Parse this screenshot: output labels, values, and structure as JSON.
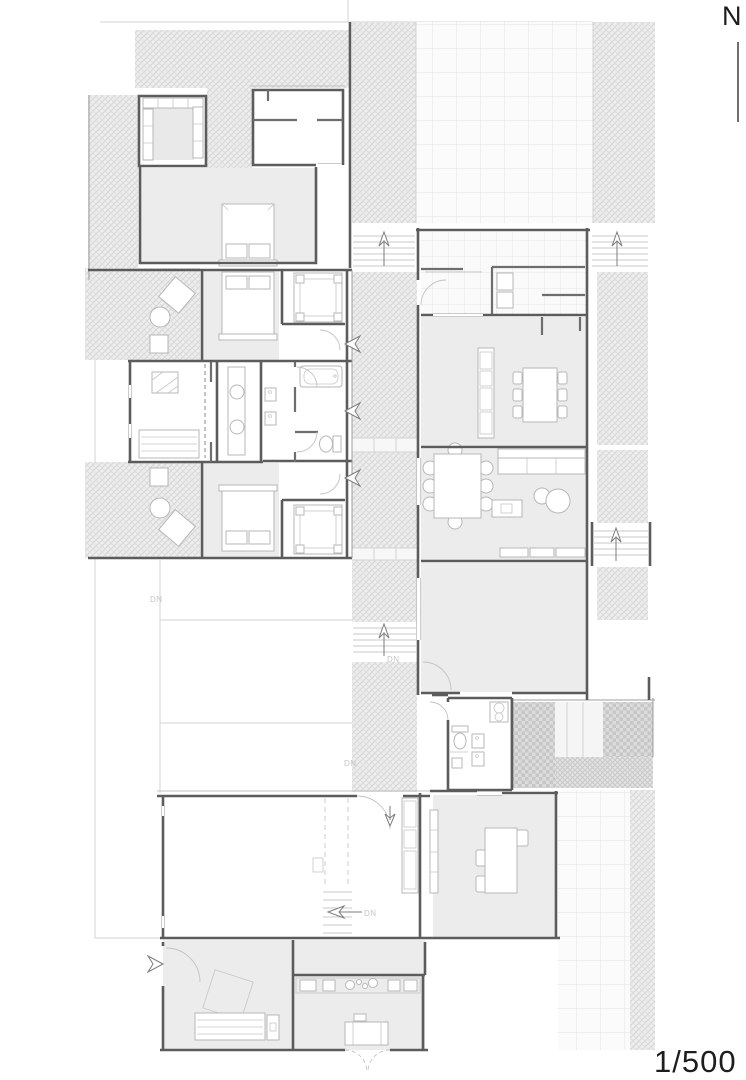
{
  "annotations": {
    "north_label": "N",
    "scale_label": "1/500",
    "dn_labels": [
      "DN",
      "DN",
      "DN",
      "DN"
    ]
  },
  "palette": {
    "wall": "#5c5c5c",
    "wall_light": "#9c9c9c",
    "room_floor": "#ececec",
    "hatch_line": "#d4d4d4",
    "tile_line": "#e3e3e3",
    "paving_dark": "#c6c6c6",
    "furniture_line": "#b7b7b7",
    "door_arc": "#c3c3c3",
    "annotation_text": "#c5c5c5",
    "label_text": "#1d1d1d"
  },
  "icons": {
    "north_indicator": "letter N with vertical line",
    "stair_up_arrow": "outlined vertical arrow",
    "stair_down_arrow": "outlined horizontal arrow",
    "entry_arrow": "concave swallow arrow",
    "door_swing": "quarter-circle arc"
  }
}
